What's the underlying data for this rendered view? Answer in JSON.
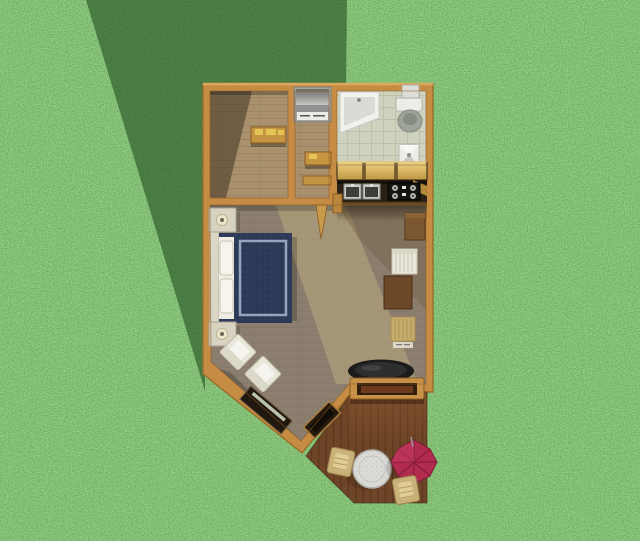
{
  "scene": {
    "type": "floor-plan-3d-top-view",
    "setting": "grass-lawn-with-building-shadow"
  },
  "colors": {
    "grass_base": "#5AA84C",
    "shadow_green": "#1A4517",
    "wall": "#C78C43",
    "wall_highlight": "#E2AE63",
    "wall_outline": "#9C6F2E",
    "wall_inner_edge": "#8A5C24",
    "wood_floor": "#A8916C",
    "wood_line": "#8F7A58",
    "floor_shadow": "#3F3425",
    "tile_floor": "#B3B89D",
    "tile_grid": "#99A087",
    "main_floor": "#8B7E6E",
    "main_line": "#7B6F60",
    "light_band": "#BFAE80",
    "warm_floor_tint": "#6F583C",
    "cabinet_light": "#EFD486",
    "cabinet_dark": "#BE9640",
    "cabinet_side": "#B08A38",
    "counter_black": "#17110B",
    "appliance_bg": "#2A2015",
    "sink_steel": "#C8C8C4",
    "sink_basin": "#3D3D39",
    "stove_black": "#141412",
    "burner_gray": "#B3B3AF",
    "tub_white": "#F1F1EE",
    "tub_inner": "#D8DBD6",
    "porcelain": "#ECECE8",
    "porcelain_shade": "#C6C9C0",
    "toilet_bowl": "#9FA49A",
    "washer_body": "#A3A39F",
    "washer_drum": "#6A6A66",
    "washer_drum_light": "#C6C6C2",
    "washer_label": "#EAEAE6",
    "shelf_tan": "#C59542",
    "shelf_item": "#E5C457",
    "headboard": "#DBD6C6",
    "pillow": "#EFEDE3",
    "bed_navy": "#2C3A57",
    "bed_trim": "#94A5BF",
    "nightstand": "#D8D2C0",
    "lamp": "#ECE6CD",
    "chair_white": "#E9E6DA",
    "chair_cushion": "#F5F4EE",
    "chair_back": "#DCD8C9",
    "fireplace_dark": "#211810",
    "fireplace_insert": "#CBD5BE",
    "console_dark": "#241A10",
    "console_trim": "#A97C3B",
    "table_brown": "#6C4728",
    "chair_gold": "#C6AC6D",
    "fridge_brown": "#7B5831",
    "stove_round": "#1B1B1B",
    "deck_wood": "#6F4527",
    "deck_line": "#54331C",
    "deck_light": "#8A562E",
    "bench_frame": "#C89148",
    "bench_inner": "#2F1D0E",
    "bench_plank": "#6E3A1E",
    "deck_table": "#DBDAD5",
    "umbrella_red": "#B12B4E",
    "umbrella_dark": "#7E1C37",
    "umbrella_light": "#C74367",
    "wicker": "#C9B177",
    "wicker_light": "#DFCD95",
    "stub_tan": "#C99A4C",
    "post_tan": "#B8863C"
  },
  "rooms": [
    {
      "name": "entry-room",
      "furniture": [
        "wall-shelf"
      ]
    },
    {
      "name": "hallway",
      "furniture": [
        "washer-dryer",
        "wall-shelf-upper",
        "wall-shelf-lower"
      ]
    },
    {
      "name": "bathroom",
      "furniture": [
        "bathtub",
        "toilet",
        "pedestal-sink",
        "wall-cabinet"
      ]
    },
    {
      "name": "kitchenette",
      "furniture": [
        "upper-cabinets",
        "double-sink",
        "range-stove",
        "refrigerator"
      ]
    },
    {
      "name": "main-room",
      "furniture": [
        "double-bed",
        "nightstand-north",
        "nightstand-south",
        "table-lamp-north",
        "table-lamp-south",
        "armchair-1",
        "armchair-2",
        "corner-fireplace",
        "corner-console",
        "dining-table",
        "dining-chair-white",
        "dining-chair-gold",
        "round-stove"
      ]
    },
    {
      "name": "deck",
      "furniture": [
        "storage-bench",
        "round-patio-table",
        "umbrella-chair",
        "wicker-chair-1",
        "wicker-chair-2"
      ]
    }
  ]
}
